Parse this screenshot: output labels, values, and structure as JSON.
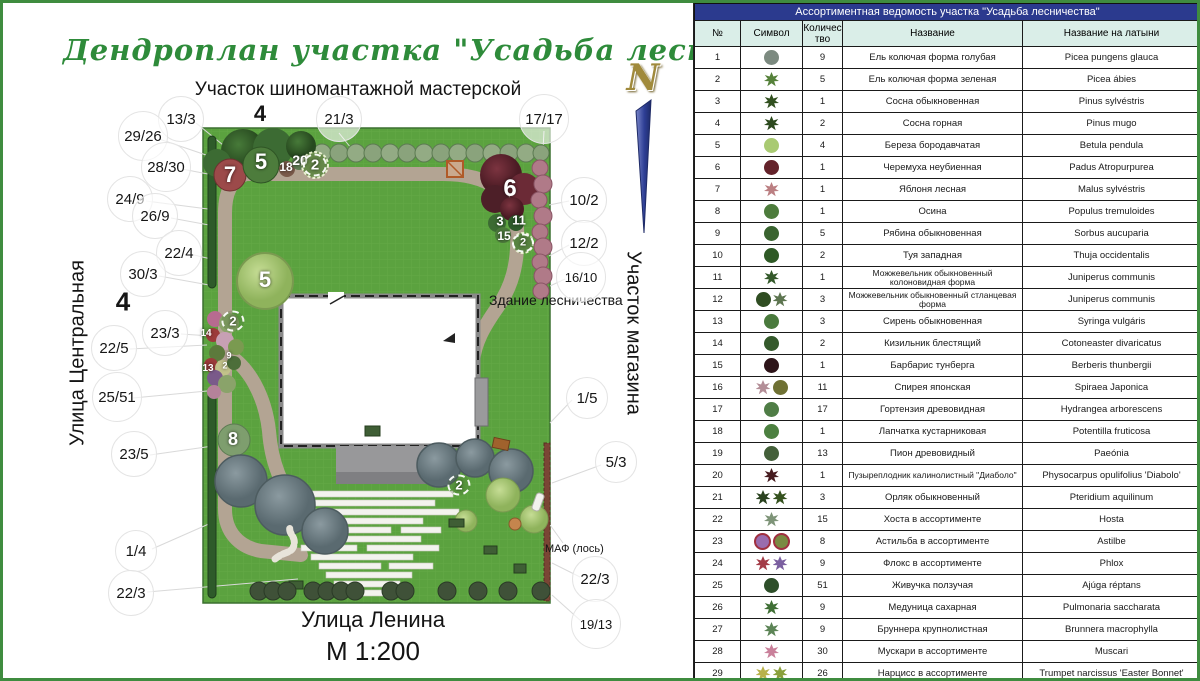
{
  "plan": {
    "title": "Дендроплан участка \"Усадьба лесничества\"",
    "subtitle": "Участок шиномантажной мастерской",
    "north_label": "N",
    "street_left": "Улица Центральная",
    "street_bottom": "Улица Ленина",
    "area_right": "Участок магазина",
    "building_label": "Здание лесничества",
    "maf_label": "МАФ (лось)",
    "scale_label": "М 1:200",
    "callouts": [
      {
        "text": "13/3",
        "x": 178,
        "y": 116
      },
      {
        "text": "4",
        "x": 257,
        "y": 111,
        "size": 22,
        "plain": true
      },
      {
        "text": "21/3",
        "x": 336,
        "y": 116
      },
      {
        "text": "17/17",
        "x": 541,
        "y": 116
      },
      {
        "text": "29/26",
        "x": 140,
        "y": 133
      },
      {
        "text": "28/30",
        "x": 163,
        "y": 164
      },
      {
        "text": "24/9",
        "x": 127,
        "y": 196
      },
      {
        "text": "26/9",
        "x": 152,
        "y": 213
      },
      {
        "text": "22/4",
        "x": 176,
        "y": 250
      },
      {
        "text": "30/3",
        "x": 140,
        "y": 271
      },
      {
        "text": "4",
        "x": 120,
        "y": 299,
        "size": 26,
        "plain": true
      },
      {
        "text": "23/3",
        "x": 162,
        "y": 330
      },
      {
        "text": "22/5",
        "x": 111,
        "y": 345
      },
      {
        "text": "25/51",
        "x": 114,
        "y": 394
      },
      {
        "text": "23/5",
        "x": 131,
        "y": 451
      },
      {
        "text": "1/4",
        "x": 133,
        "y": 548
      },
      {
        "text": "22/3",
        "x": 128,
        "y": 590
      },
      {
        "text": "10/2",
        "x": 581,
        "y": 197
      },
      {
        "text": "12/2",
        "x": 581,
        "y": 240
      },
      {
        "text": "16/10",
        "x": 578,
        "y": 274,
        "size": 13
      },
      {
        "text": "1/5",
        "x": 584,
        "y": 395
      },
      {
        "text": "5/3",
        "x": 613,
        "y": 459
      },
      {
        "text": "22/3",
        "x": 592,
        "y": 576
      },
      {
        "text": "19/13",
        "x": 593,
        "y": 621,
        "size": 13
      }
    ],
    "numbers": [
      {
        "text": "7",
        "x": 227,
        "y": 172,
        "size": 22
      },
      {
        "text": "5",
        "x": 258,
        "y": 159,
        "size": 22
      },
      {
        "text": "18",
        "x": 283,
        "y": 164,
        "size": 12
      },
      {
        "text": "20",
        "x": 297,
        "y": 157,
        "size": 14
      },
      {
        "text": "2",
        "x": 312,
        "y": 162,
        "size": 15,
        "circled": true
      },
      {
        "text": "6",
        "x": 507,
        "y": 186,
        "size": 24
      },
      {
        "text": "3",
        "x": 497,
        "y": 218,
        "size": 13
      },
      {
        "text": "11",
        "x": 516,
        "y": 217,
        "size": 13
      },
      {
        "text": "15",
        "x": 501,
        "y": 233,
        "size": 12
      },
      {
        "text": "2",
        "x": 520,
        "y": 240,
        "size": 11,
        "circled": true
      },
      {
        "text": "5",
        "x": 262,
        "y": 277,
        "size": 22
      },
      {
        "text": "2",
        "x": 230,
        "y": 318,
        "size": 13,
        "circled": true
      },
      {
        "text": "14",
        "x": 203,
        "y": 331,
        "size": 10
      },
      {
        "text": "9",
        "x": 226,
        "y": 353,
        "size": 9
      },
      {
        "text": "2",
        "x": 222,
        "y": 363,
        "size": 9
      },
      {
        "text": "13",
        "x": 205,
        "y": 366,
        "size": 10
      },
      {
        "text": "8",
        "x": 230,
        "y": 436,
        "size": 18
      },
      {
        "text": "2",
        "x": 456,
        "y": 482,
        "size": 13,
        "circled": true
      }
    ]
  },
  "table": {
    "title": "Ассортиментная ведомость участка \"Усадьба лесничества\"",
    "columns": [
      "№",
      "Символ",
      "Количество",
      "Название",
      "Название на латыни"
    ],
    "rows": [
      {
        "num": "1",
        "qty": "9",
        "name": "Ель колючая форма голубая",
        "latin": "Picea pungens glauca",
        "sym": [
          {
            "c": "#7c8a80",
            "s": "circle"
          }
        ]
      },
      {
        "num": "2",
        "qty": "5",
        "name": "Ель колючая форма зеленая",
        "latin": "Picea ábies",
        "sym": [
          {
            "c": "#55813a",
            "s": "star"
          }
        ]
      },
      {
        "num": "3",
        "qty": "1",
        "name": "Сосна обыкновенная",
        "latin": "Pinus sylvéstris",
        "sym": [
          {
            "c": "#31501f",
            "s": "star"
          }
        ]
      },
      {
        "num": "4",
        "qty": "2",
        "name": "Сосна горная",
        "latin": "Pinus mugo",
        "sym": [
          {
            "c": "#2d4a1e",
            "s": "star"
          }
        ]
      },
      {
        "num": "5",
        "qty": "4",
        "name": "Береза бородавчатая",
        "latin": "Betula pendula",
        "sym": [
          {
            "c": "#a9ca72",
            "s": "circle"
          }
        ]
      },
      {
        "num": "6",
        "qty": "1",
        "name": "Черемуха неубиенная",
        "latin": "Padus Atropurpurea",
        "sym": [
          {
            "c": "#64232b",
            "s": "circle"
          }
        ]
      },
      {
        "num": "7",
        "qty": "1",
        "name": "Яблоня лесная",
        "latin": "Malus sylvéstris",
        "sym": [
          {
            "c": "#bb7f82",
            "s": "star"
          }
        ]
      },
      {
        "num": "8",
        "qty": "1",
        "name": "Осина",
        "latin": "Populus tremuloides",
        "sym": [
          {
            "c": "#4d7c3c",
            "s": "circle"
          }
        ]
      },
      {
        "num": "9",
        "qty": "5",
        "name": "Рябина обыкновенная",
        "latin": "Sorbus aucuparia",
        "sym": [
          {
            "c": "#3a6430",
            "s": "circle"
          }
        ]
      },
      {
        "num": "10",
        "qty": "2",
        "name": "Туя западная",
        "latin": "Thuja occidentalis",
        "sym": [
          {
            "c": "#2f5a26",
            "s": "circle"
          }
        ]
      },
      {
        "num": "11",
        "qty": "1",
        "name": "Можжевельник обыкновенный колоновидная форма",
        "latin": "Juniperus communis",
        "sym": [
          {
            "c": "#33592a",
            "s": "star"
          }
        ]
      },
      {
        "num": "12",
        "qty": "3",
        "name": "Можжевельник обыкновенный стланцевая форма",
        "latin": "Juniperus communis",
        "sym": [
          {
            "c": "#2f4d22",
            "s": "circle"
          },
          {
            "c": "#5d7550",
            "s": "star"
          }
        ]
      },
      {
        "num": "13",
        "qty": "3",
        "name": "Сирень обыкновенная",
        "latin": "Syringa vulgáris",
        "sym": [
          {
            "c": "#4a7a3d",
            "s": "circle"
          }
        ]
      },
      {
        "num": "14",
        "qty": "2",
        "name": "Кизильник блестящий",
        "latin": "Cotoneaster divaricatus",
        "sym": [
          {
            "c": "#355a2c",
            "s": "circle"
          }
        ]
      },
      {
        "num": "15",
        "qty": "1",
        "name": "Барбарис тунберга",
        "latin": "Berberis thunbergii",
        "sym": [
          {
            "c": "#2e151a",
            "s": "circle"
          }
        ]
      },
      {
        "num": "16",
        "qty": "11",
        "name": "Спирея японская",
        "latin": "Spiraea Japonica",
        "sym": [
          {
            "c": "#b38e97",
            "s": "star"
          },
          {
            "c": "#6f7134",
            "s": "circle"
          }
        ]
      },
      {
        "num": "17",
        "qty": "17",
        "name": "Гортензия древовидная",
        "latin": "Hydrangea arborescens",
        "sym": [
          {
            "c": "#4f7d46",
            "s": "circle"
          }
        ]
      },
      {
        "num": "18",
        "qty": "1",
        "name": "Лапчатка кустарниковая",
        "latin": "Potentilla fruticosa",
        "sym": [
          {
            "c": "#4c8040",
            "s": "circle"
          }
        ]
      },
      {
        "num": "19",
        "qty": "13",
        "name": "Пион древовидный",
        "latin": "Paeónia",
        "sym": [
          {
            "c": "#44603a",
            "s": "circle"
          }
        ]
      },
      {
        "num": "20",
        "qty": "1",
        "name": "Пузыреплодник калинолистный \"Диаболо\"",
        "latin": "Physocarpus opulifolius 'Diabolo'",
        "sym": [
          {
            "c": "#471c20",
            "s": "star"
          }
        ]
      },
      {
        "num": "21",
        "qty": "3",
        "name": "Орляк обыкновенный",
        "latin": "Pteridium aquilinum",
        "sym": [
          {
            "c": "#2a421f",
            "s": "star"
          },
          {
            "c": "#35521f",
            "s": "star"
          }
        ]
      },
      {
        "num": "22",
        "qty": "15",
        "name": "Хоста в ассортименте",
        "latin": "Hosta",
        "sym": [
          {
            "c": "#7e9478",
            "s": "star"
          }
        ]
      },
      {
        "num": "23",
        "qty": "8",
        "name": "Астильба в ассортименте",
        "latin": "Astilbe",
        "sym": [
          {
            "c": "#9a6cae",
            "s": "circle",
            "r": "#a03040"
          },
          {
            "c": "#7a8a42",
            "s": "circle",
            "r": "#a03040"
          }
        ]
      },
      {
        "num": "24",
        "qty": "9",
        "name": "Флокс в ассортименте",
        "latin": "Phlox",
        "sym": [
          {
            "c": "#a43b47",
            "s": "star"
          },
          {
            "c": "#7b5fa0",
            "s": "star"
          }
        ]
      },
      {
        "num": "25",
        "qty": "51",
        "name": "Живучка ползучая",
        "latin": "Ajúga réptans",
        "sym": [
          {
            "c": "#2e4f2a",
            "s": "circle"
          }
        ]
      },
      {
        "num": "26",
        "qty": "9",
        "name": "Медуница сахарная",
        "latin": "Pulmonaria saccharata",
        "sym": [
          {
            "c": "#3f6f35",
            "s": "star"
          }
        ]
      },
      {
        "num": "27",
        "qty": "9",
        "name": "Бруннера крупнолистная",
        "latin": "Brunnera macrophylla",
        "sym": [
          {
            "c": "#5c8456",
            "s": "star"
          }
        ]
      },
      {
        "num": "28",
        "qty": "30",
        "name": "Мускари в ассортименте",
        "latin": "Muscari",
        "sym": [
          {
            "c": "#c9809a",
            "s": "star"
          }
        ]
      },
      {
        "num": "29",
        "qty": "26",
        "name": "Нарцисс в ассортименте",
        "latin": "Trumpet narcissus 'Easter Bonnet'",
        "sym": [
          {
            "c": "#b9b24a",
            "s": "star"
          },
          {
            "c": "#8aa03c",
            "s": "star"
          }
        ]
      },
      {
        "num": "30",
        "qty": "3",
        "name": "Бадан толстолистный",
        "latin": "Bergenia agavifolia",
        "sym": [
          {
            "c": "#2e4f2a",
            "s": "circle"
          }
        ]
      }
    ]
  },
  "colors": {
    "frame": "#3f8c3f",
    "table_header_bg": "#2b3a8e",
    "table_subheader_bg": "#daeee8",
    "lawn": "#5ba23f",
    "path": "#b3a493",
    "title_green": "#2e8b3a"
  }
}
